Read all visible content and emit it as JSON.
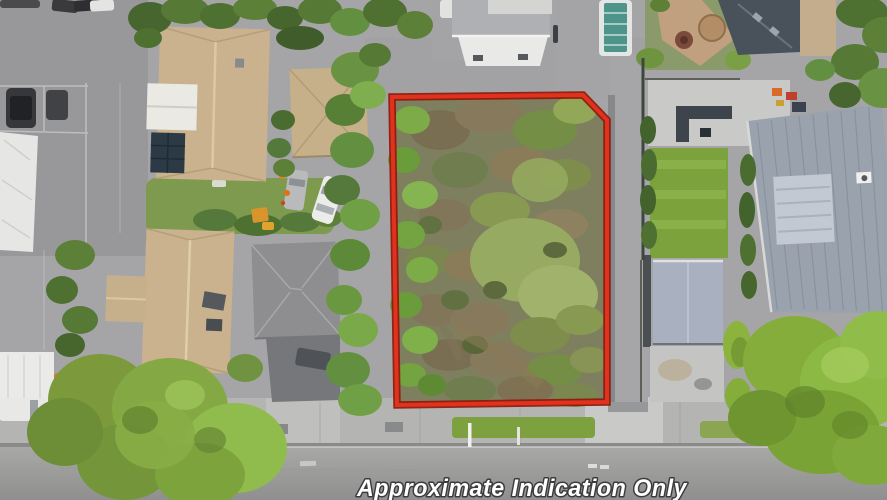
{
  "scene": {
    "type": "aerial-drone-photo",
    "subject": "vacant residential section outlined in red among suburban houses",
    "caption": "Approximate Indication Only"
  },
  "boundary": {
    "points": "392,97 583,95 607,120 607,402 397,405",
    "color": "#e0321f",
    "outline_color": "#8f1606"
  },
  "colors": {
    "caption_fill": "#ffffff",
    "caption_outline": "#3b3b3b",
    "lot_ground": "#7e7f5f",
    "road": "#a2a2a0",
    "footpath": "#b4b4b2",
    "tan_roof": "#c9b28d",
    "gray_roof": "#8e8e90",
    "metal_roof": "#9aa3ad",
    "tree_green": "#84ad3c"
  }
}
